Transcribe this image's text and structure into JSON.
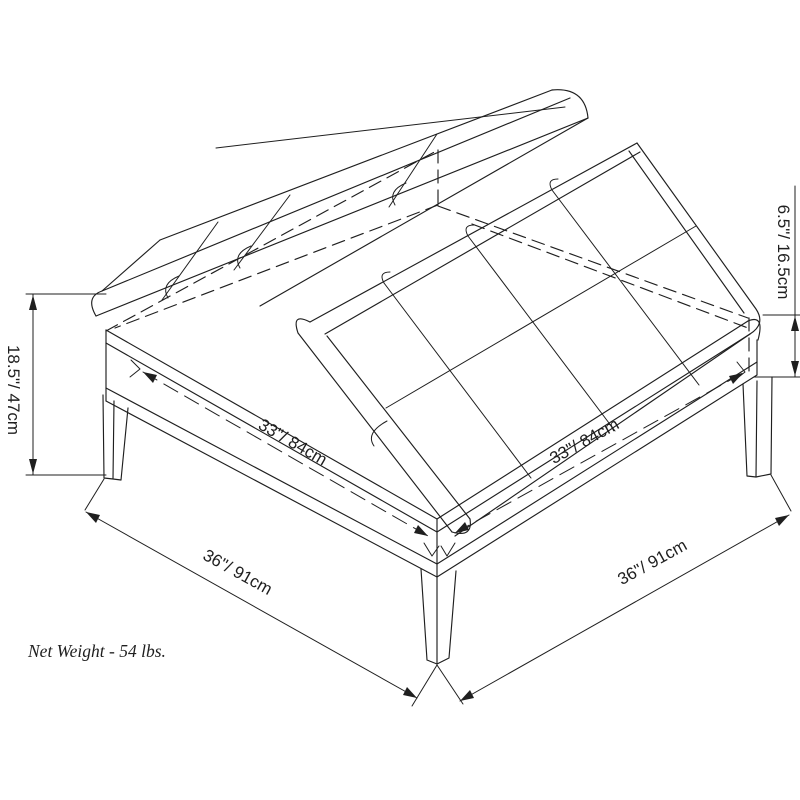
{
  "diagram": {
    "background": "#ffffff",
    "line_color": "#1f1f1f",
    "dimensions": {
      "height_left": "18.5\"/ 47cm",
      "height_right": "6.5\"/ 16.5cm",
      "top_edge_left": "33\"/ 84cm",
      "top_edge_right": "33\"/ 84cm",
      "base_edge_left": "36\"/ 91cm",
      "base_edge_right": "36\"/ 91cm"
    },
    "note": "Net Weight - 54 lbs."
  }
}
